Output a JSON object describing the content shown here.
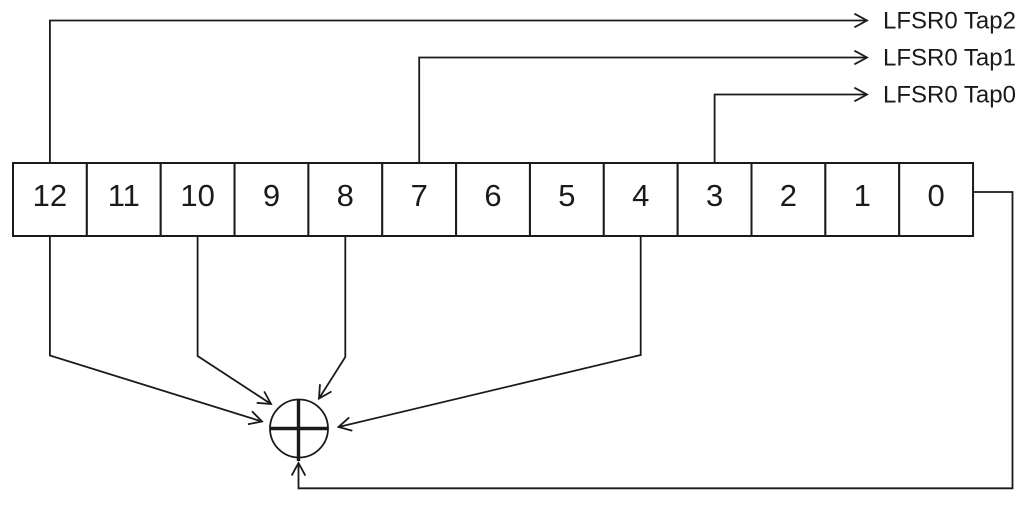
{
  "diagram": {
    "kind": "lfsr-shift-register-feedback",
    "register_cells": [
      "12",
      "11",
      "10",
      "9",
      "8",
      "7",
      "6",
      "5",
      "4",
      "3",
      "2",
      "1",
      "0"
    ],
    "taps": [
      {
        "label": "LFSR0 Tap2",
        "source_cell": "12"
      },
      {
        "label": "LFSR0 Tap1",
        "source_cell": "7"
      },
      {
        "label": "LFSR0 Tap0",
        "source_cell": "3"
      }
    ],
    "xor": {
      "input_cells": [
        "12",
        "10",
        "8",
        "4"
      ],
      "feedback_from_cell": "0"
    },
    "colors": {
      "line": "#1a1a1a",
      "background": "#ffffff"
    }
  }
}
